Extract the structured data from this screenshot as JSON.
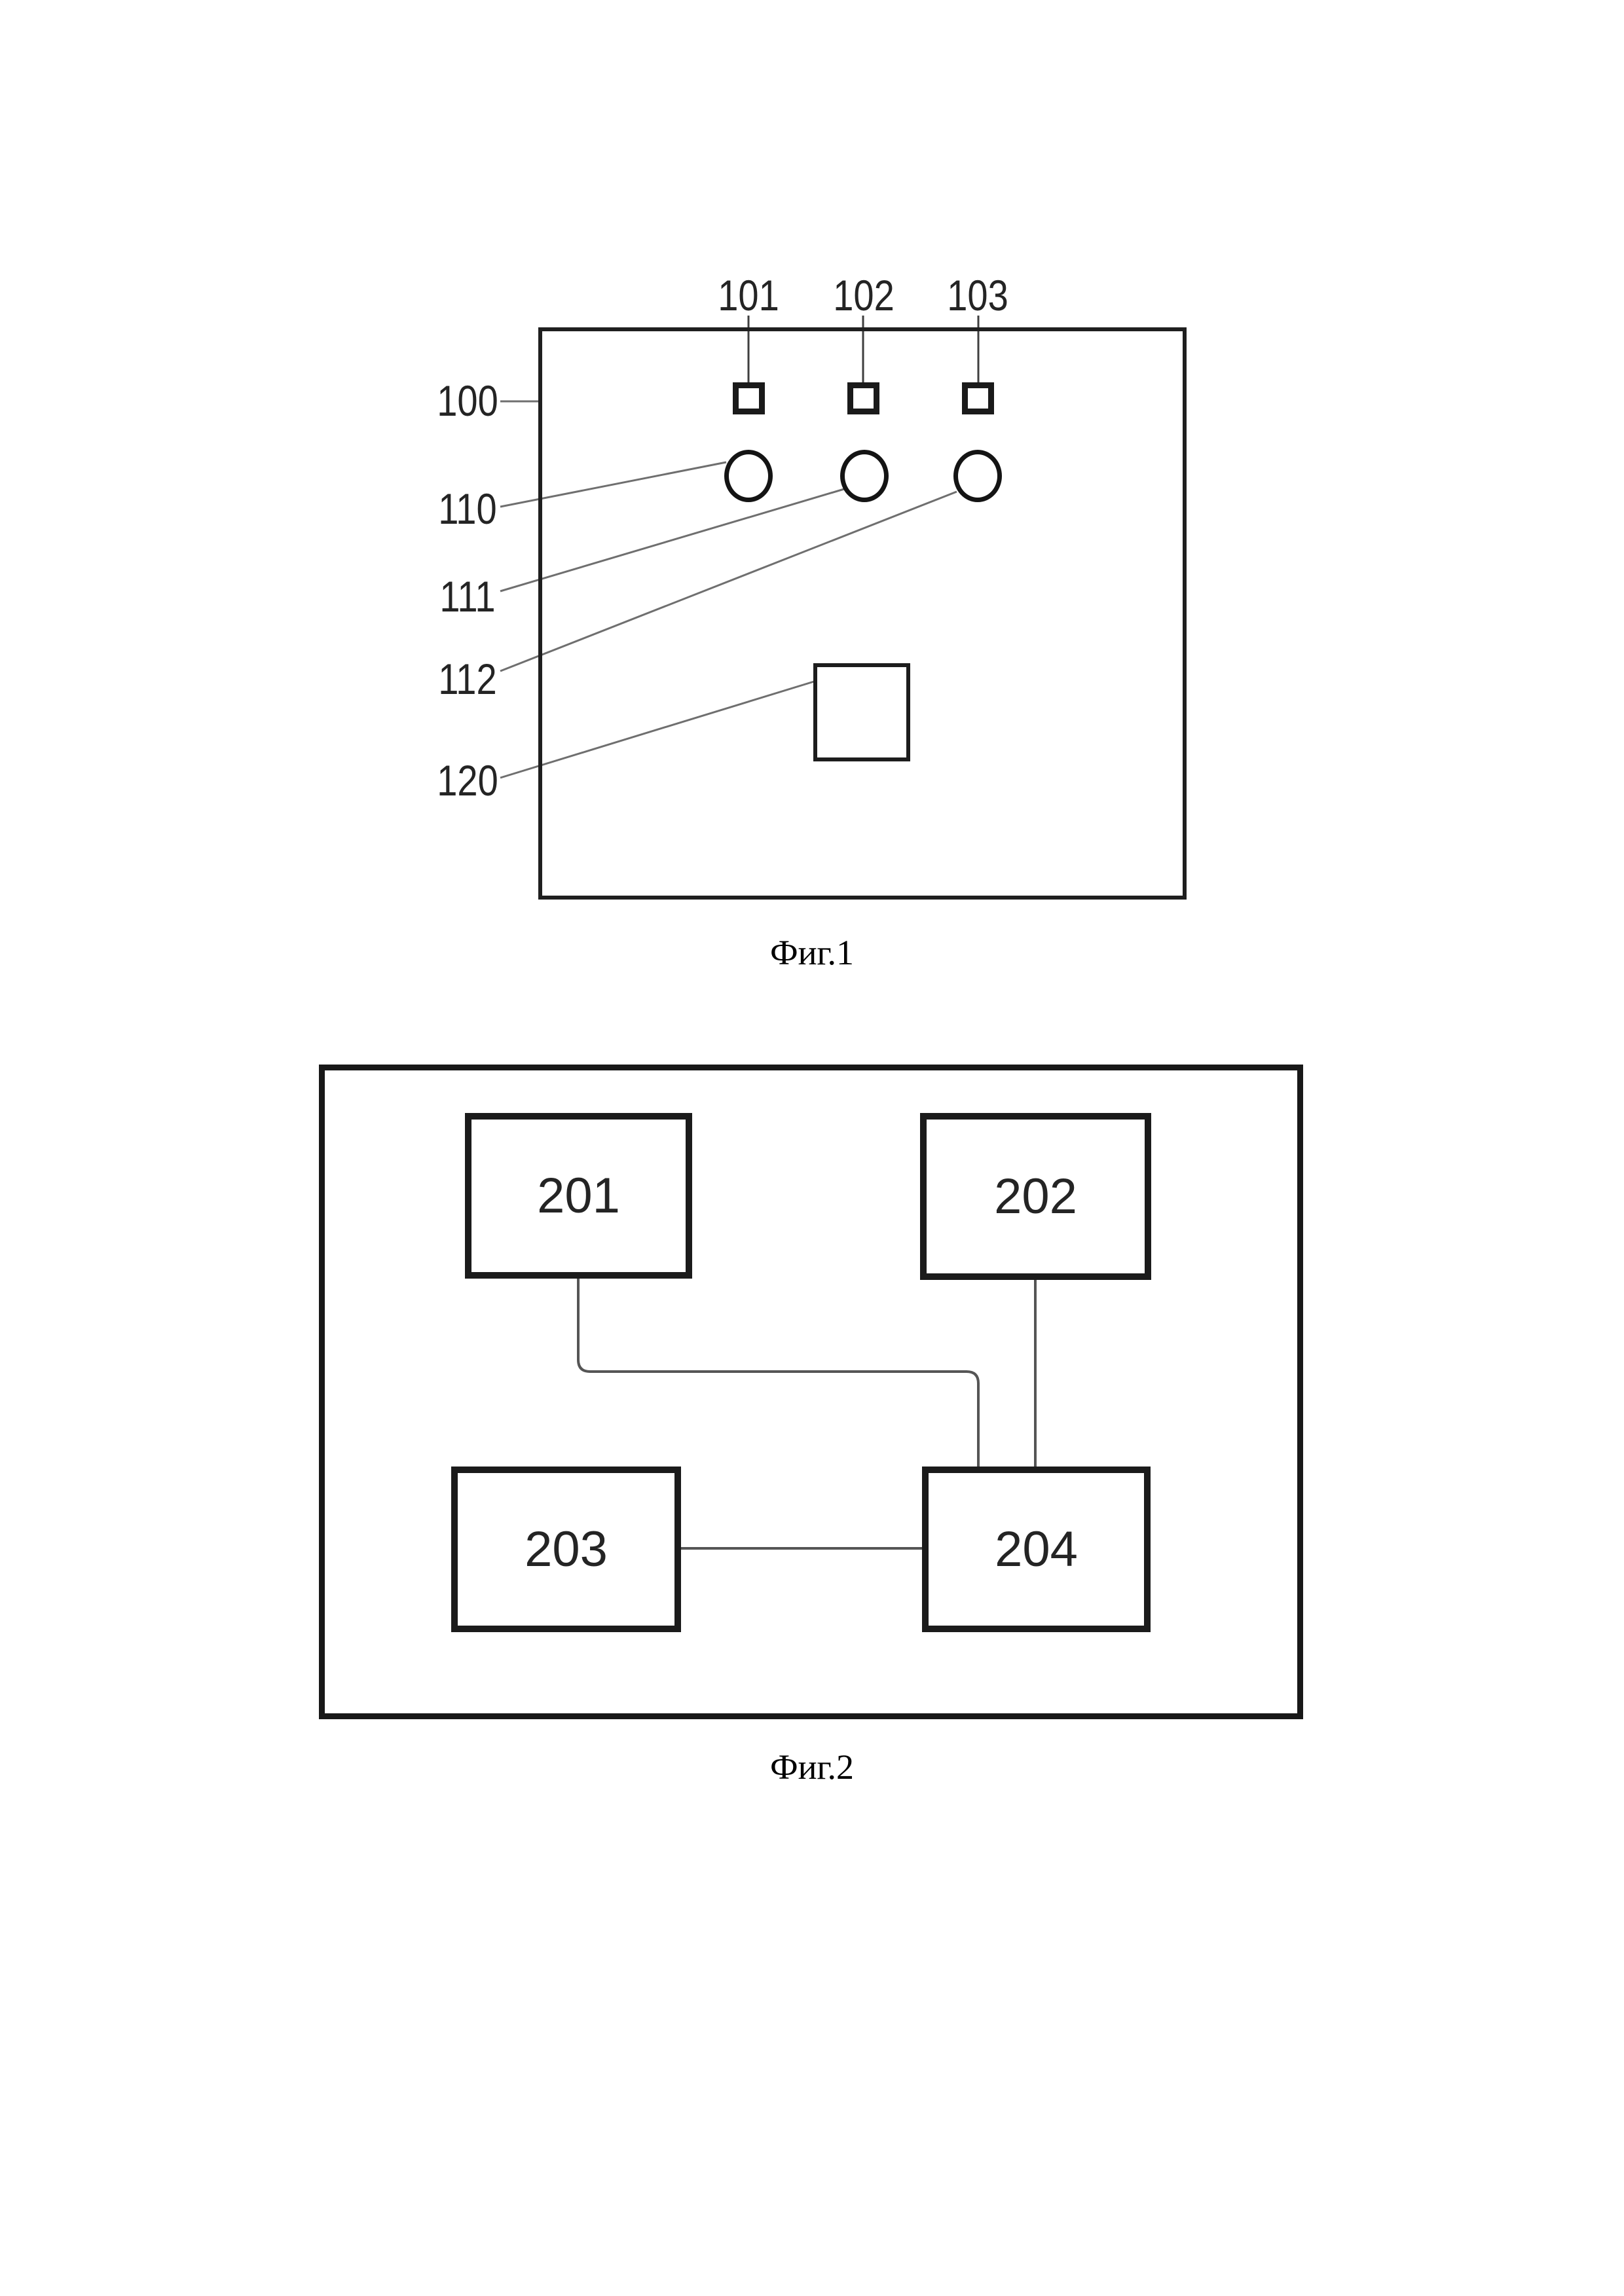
{
  "page": {
    "background": "#ffffff"
  },
  "figure1": {
    "caption": "Фиг.1",
    "device_label": "100",
    "port_labels": [
      "101",
      "102",
      "103"
    ],
    "indicator_labels": [
      "110",
      "111",
      "112"
    ],
    "module_label": "120"
  },
  "figure2": {
    "caption": "Фиг.2",
    "block_labels": [
      "201",
      "202",
      "203",
      "204"
    ]
  },
  "colors": {
    "outline": "#1f1f1f",
    "leader_line": "#6f6f6f",
    "stub_line": "#3f3f3f",
    "connector_line": "#555555",
    "text": "#242424"
  }
}
